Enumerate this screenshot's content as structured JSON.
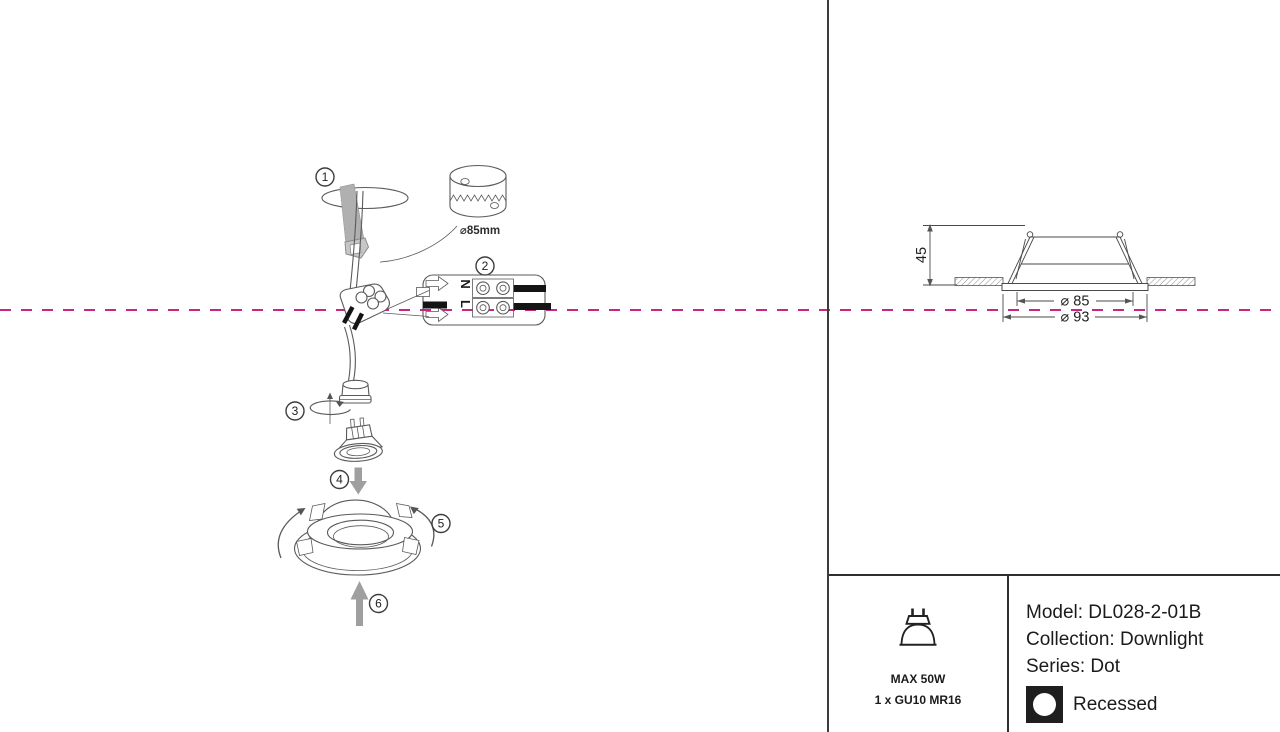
{
  "badges": {
    "one": "1",
    "two": "2",
    "three": "3",
    "four": "4",
    "five": "5",
    "six": "6"
  },
  "installation": {
    "hole_saw_label": "⌀85mm",
    "terminal_n": "N",
    "terminal_l": "L"
  },
  "drawing": {
    "height": "45",
    "cutout": "⌀ 85",
    "outer": "⌀ 93"
  },
  "panel": {
    "max_power": "MAX 50W",
    "lamp_type": "1 x GU10 MR16",
    "model": "Model: DL028-2-01B",
    "collection": "Collection: Downlight",
    "series": "Series: Dot",
    "mounting": "Recessed"
  },
  "colors": {
    "cut_line": "#cb2484",
    "line_art": "#5a5a5a",
    "wire_black": "#141414",
    "arrow_gray": "#9f9f9f"
  }
}
